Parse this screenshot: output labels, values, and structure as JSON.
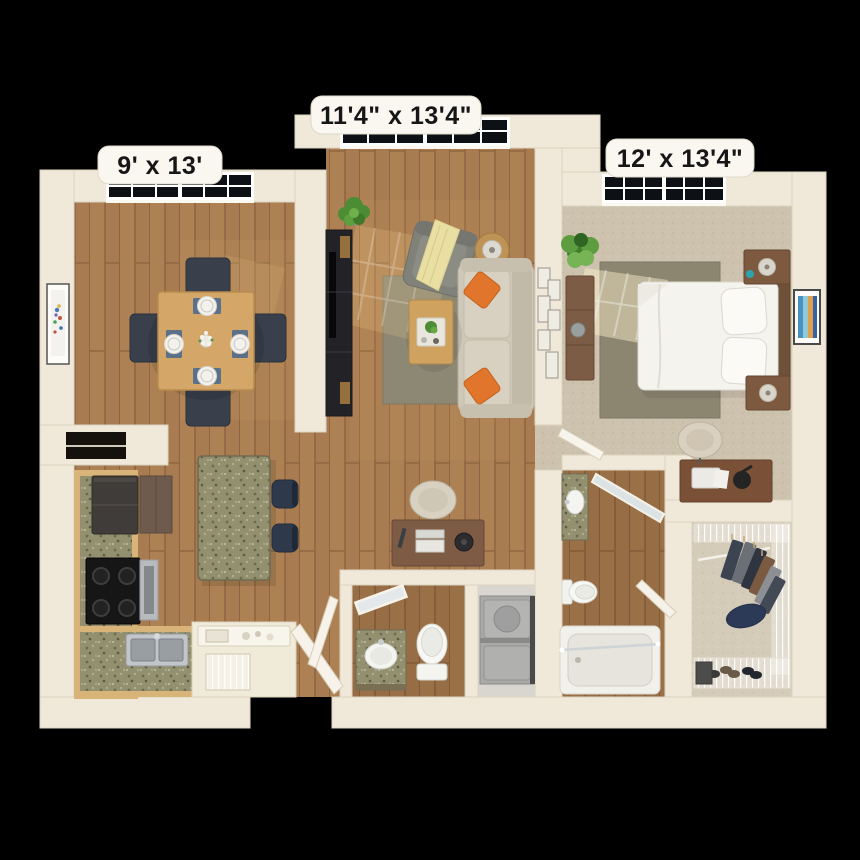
{
  "image": {
    "type": "3d-floor-plan-render",
    "view": "top-down dollhouse view of one-bedroom apartment",
    "background_color": "#000000"
  },
  "rooms": [
    {
      "name": "dining-area",
      "dimension_label": "9' x 13'"
    },
    {
      "name": "living-room",
      "dimension_label": "11'4\" x 13'4\""
    },
    {
      "name": "bedroom",
      "dimension_label": "12' x 13'4\""
    },
    {
      "name": "kitchen"
    },
    {
      "name": "entry"
    },
    {
      "name": "bathroom"
    },
    {
      "name": "laundry-closet"
    },
    {
      "name": "ensuite-bathroom"
    },
    {
      "name": "walk-in-closet"
    }
  ],
  "palette": {
    "wall": "#f0e9da",
    "wood_floor": "#a87c50",
    "bedroom_carpet": "#cdc2ad",
    "area_rug": "#8c8874",
    "granite_counter": "#93906f",
    "sofa": "#cfc8b8",
    "accent_pillow": "#e0752b",
    "throw_blanket": "#e9dfa2",
    "dining_chair_navy": "#39404c",
    "plant_green": "#4c8c34",
    "window_glass": "#0d1014",
    "label_background": "#faf7f0",
    "label_text": "#161616"
  }
}
